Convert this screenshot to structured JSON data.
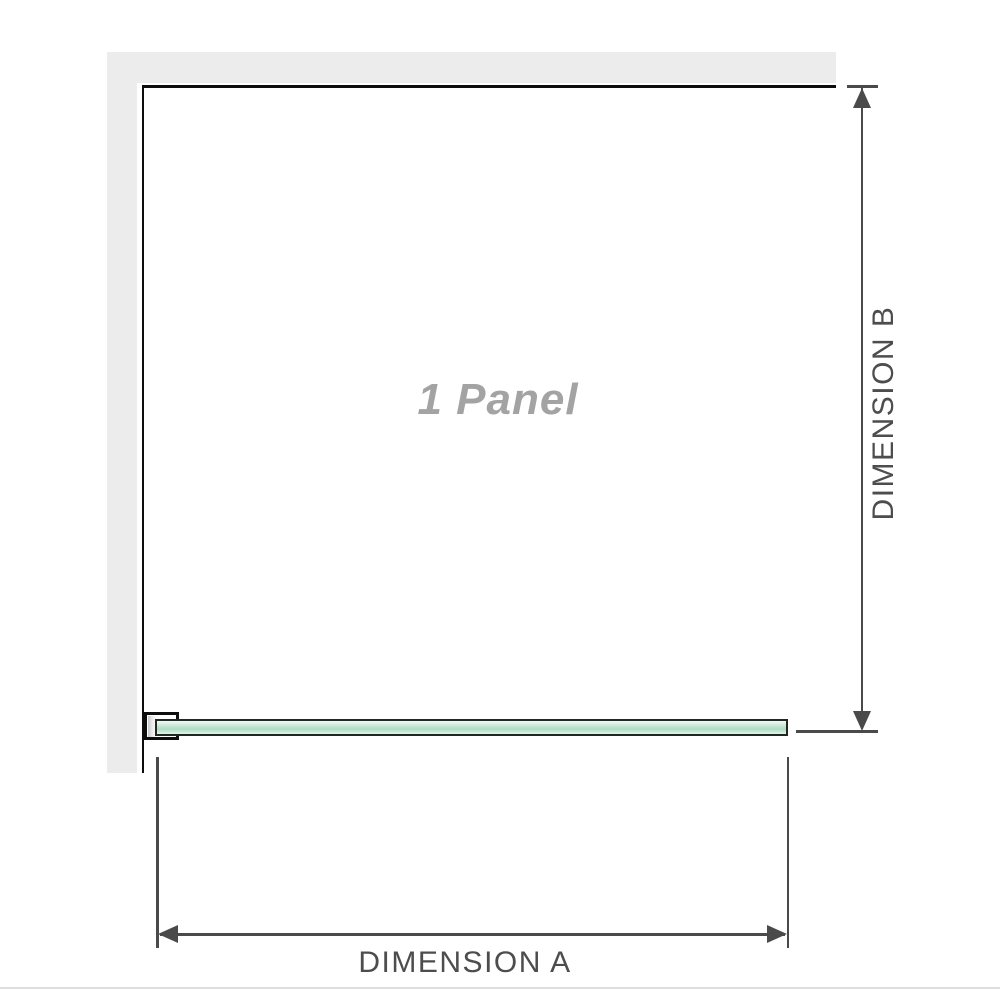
{
  "diagram": {
    "panel_label": "1 Panel",
    "dimension_a_label": "DIMENSION A",
    "dimension_b_label": "DIMENSION B"
  },
  "colors": {
    "wall": "#ececec",
    "panel_border": "#0d0d0d",
    "glass_border": "#1f2921",
    "glass_fill_light": "#f2faf5",
    "glass_fill_mid": "#aedcc2",
    "dimension_line": "#4a4a4a",
    "dimension_text": "#4d4d4d",
    "label_gray": "#a3a3a3",
    "divider": "#dedede"
  }
}
